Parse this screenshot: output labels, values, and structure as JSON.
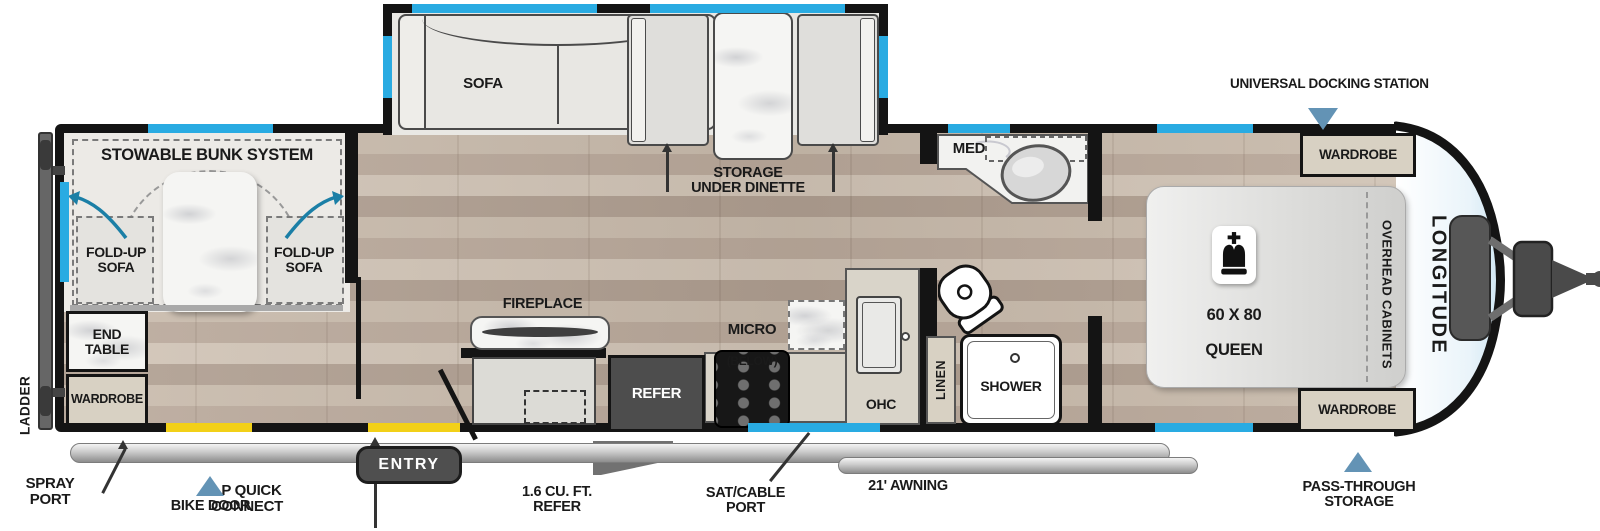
{
  "floorplan": {
    "brand": "LONGITUDE",
    "colors": {
      "window": "#29abe2",
      "accent_yellow": "#f2d018",
      "marker_blue": "#6393b5",
      "arrow_blue": "#1b7fa6",
      "wall": "#141414"
    },
    "rear": {
      "ladder": "LADDER",
      "spray_port": "SPRAY\nPORT",
      "lp_quick_connect": "LP QUICK\nCONNECT",
      "bike_door": "BIKE DOOR"
    },
    "bunk_room": {
      "title": "STOWABLE BUNK SYSTEM",
      "fold_up_sofa_left": "FOLD-UP\nSOFA",
      "fold_up_sofa_right": "FOLD-UP\nSOFA",
      "end_table": "END\nTABLE",
      "wardrobe": "WARDROBE"
    },
    "living": {
      "sofa": "SOFA",
      "storage_under_dinette": "STORAGE\nUNDER DINETTE",
      "fireplace": "FIREPLACE",
      "entry": "ENTRY",
      "exterior_refer": "1.6 CU. FT.\nREFER"
    },
    "kitchen": {
      "refer": "REFER",
      "micro": "MICRO",
      "micro_below": "(BELOW)",
      "ohc": "OHC",
      "sat_cable_port": "SAT/CABLE\nPORT",
      "awning": "21' AWNING"
    },
    "bath": {
      "med": "MED",
      "linen": "LINEN",
      "shower": "SHOWER"
    },
    "bedroom": {
      "bed_size": "60 X 80",
      "bed_type": "QUEEN",
      "overhead_cabinets": "OVERHEAD CABINETS",
      "wardrobe_top": "WARDROBE",
      "wardrobe_bottom": "WARDROBE"
    },
    "front": {
      "universal_docking_station": "UNIVERSAL DOCKING STATION",
      "pass_through_storage": "PASS-THROUGH\nSTORAGE"
    }
  }
}
